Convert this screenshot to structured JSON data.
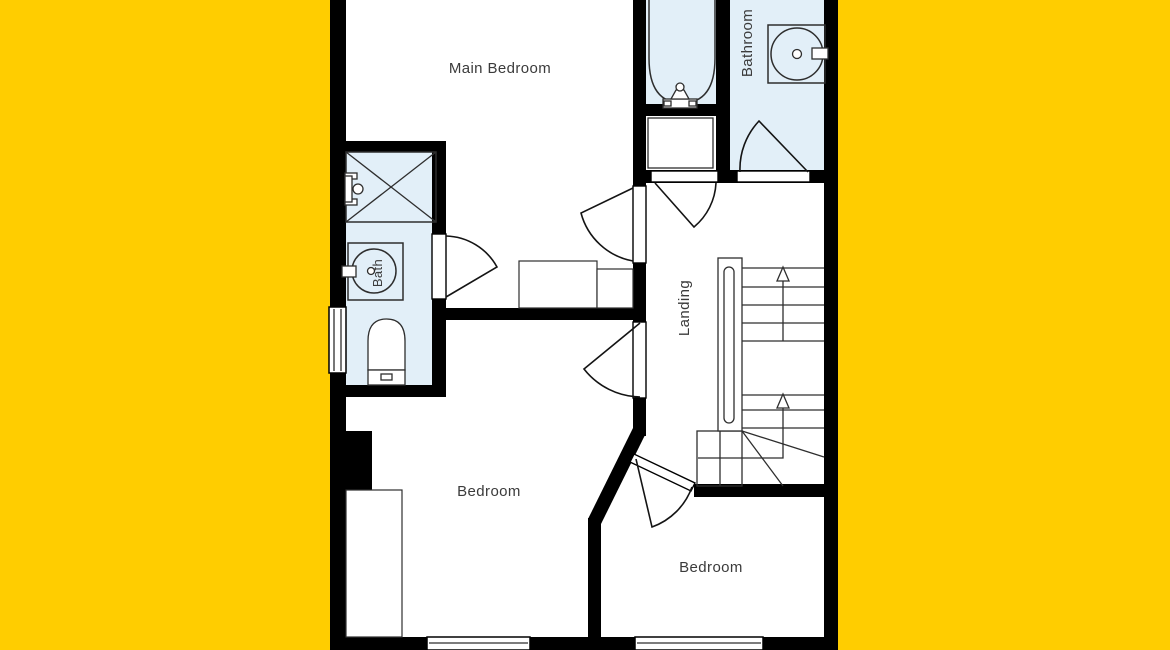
{
  "palette": {
    "background": "#FFCD00",
    "wall": "#000000",
    "room": "#FFFFFF",
    "wet_room": "#E2EFF8",
    "line": "#2E2E2E",
    "label_text": "#3B3B3B"
  },
  "labels": {
    "main_bedroom": "Main Bedroom",
    "bathroom": "Bathroom",
    "bath": "Bath",
    "landing": "Landing",
    "bedroom_center": "Bedroom",
    "bedroom_right": "Bedroom"
  },
  "icons": [
    "bathtub-icon",
    "bath-taps-icon",
    "washbasin-icon",
    "sink-tap-icon",
    "shower-enclosure-icon",
    "shower-valve-icon",
    "toilet-icon",
    "stairs-icon",
    "stairs-up-arrow-icon",
    "door-swing-icon",
    "window-icon",
    "wardrobe-icon",
    "cupboard-icon",
    "furniture-icon"
  ]
}
